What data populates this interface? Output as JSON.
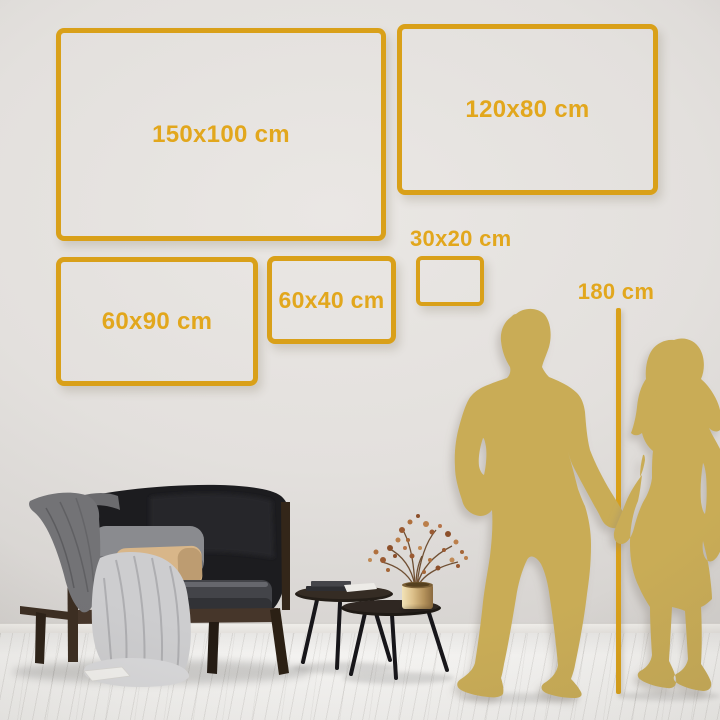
{
  "size_guide": {
    "frames": [
      {
        "label": "150x100 cm"
      },
      {
        "label": "120x80 cm"
      },
      {
        "label": "30x20 cm"
      },
      {
        "label": "60x90 cm"
      },
      {
        "label": "60x40 cm"
      }
    ],
    "height_marker_label": "180 cm"
  },
  "colors": {
    "frame_gold": "#D9A019",
    "label_gold": "#E2A71D",
    "silhouette_gold": "#C9AC56",
    "wall": "#E4E1DE",
    "floor": "#F3F2F0"
  },
  "illustrations": {
    "figures": "man and woman silhouettes holding hands",
    "sofa": "dark loveseat with wood frame, grey and tan pillows, draped blankets",
    "tables": "two round nesting coffee tables with books and brass vase of dried branches"
  }
}
